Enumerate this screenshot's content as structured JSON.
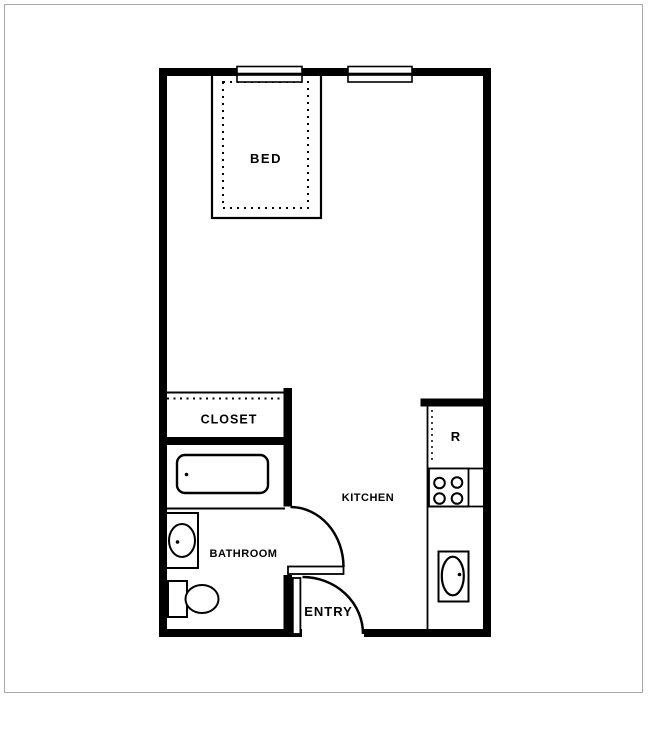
{
  "colors": {
    "wall": "#000000",
    "line": "#000000",
    "text": "#000000",
    "background": "#ffffff",
    "frame": "#a8a8a8"
  },
  "floor_plan": {
    "type": "studio-apartment-floor-plan",
    "labels": {
      "bed": "BED",
      "closet": "CLOSET",
      "bathroom": "BATHROOM",
      "kitchen": "KITCHEN",
      "entry": "ENTRY",
      "refrigerator": "R"
    },
    "fixtures": [
      "bed",
      "window",
      "window",
      "closet-rod",
      "bathtub",
      "bathroom-sink",
      "toilet",
      "bathroom-door",
      "entry-door",
      "refrigerator",
      "stove-burners",
      "kitchen-sink",
      "kitchen-counter"
    ]
  }
}
